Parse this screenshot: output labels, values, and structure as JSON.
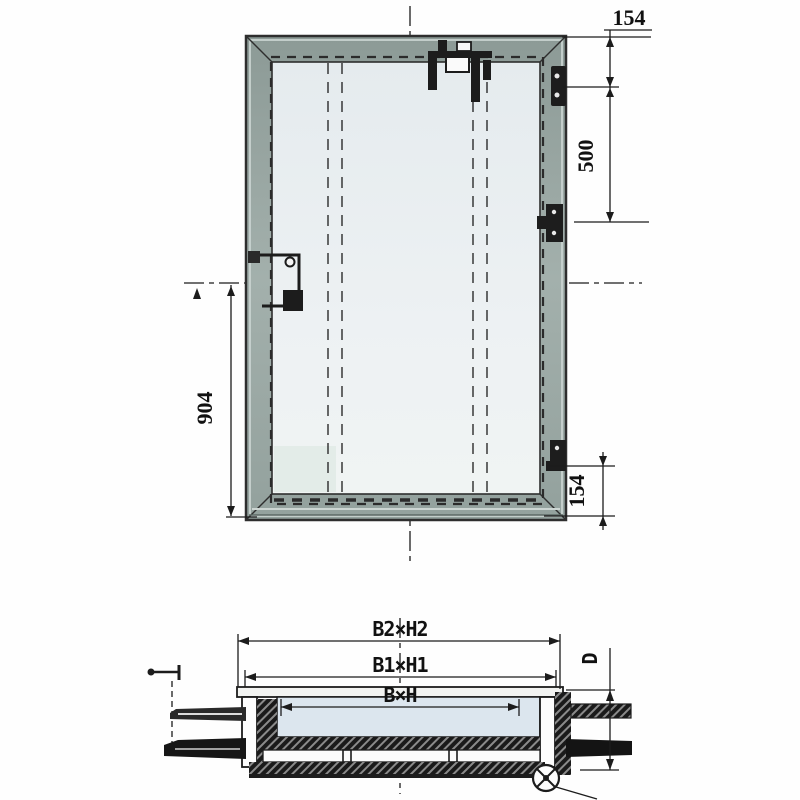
{
  "front_view": {
    "dim_top_right": "154",
    "dim_hinge_spacing": "500",
    "dim_bottom_right": "154",
    "dim_handle_height": "904"
  },
  "section_view": {
    "dim_frame_outer": "B2×H2",
    "dim_frame_middle": "B1×H1",
    "dim_clear_opening": "B×H",
    "dim_depth": "D"
  },
  "colors": {
    "frame_metal": "#9aa8a4",
    "panel_fill": "#e9eef1",
    "line": "#1c1c1c"
  }
}
